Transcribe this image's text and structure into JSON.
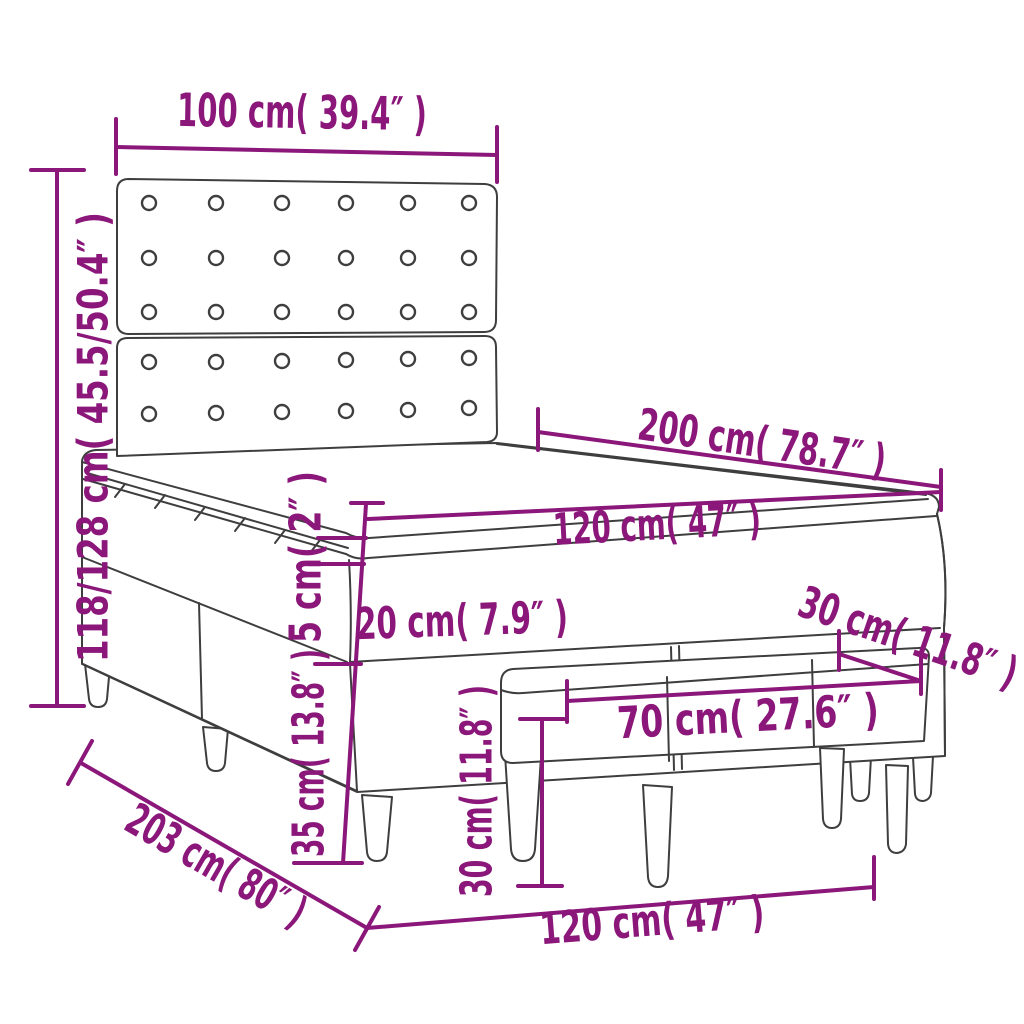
{
  "title": "Box spring bed with headboard and bench - dimension diagram",
  "colors": {
    "background": "#ffffff",
    "outline": "#3e3e3e",
    "dimension": "#8a1779"
  },
  "figure": {
    "type": "product-dimension-line-drawing",
    "components": [
      "headboard with buttons",
      "mattress topper",
      "mattress",
      "box spring base",
      "bed legs",
      "bench",
      "bench legs"
    ]
  },
  "dimensions": {
    "headboard_width": {
      "label": "100 cm( 39.4″ )",
      "cm": "100",
      "inch": "39.4"
    },
    "bed_height": {
      "label": "118/128 cm( 45.5/50.4″ )",
      "cm": "118/128",
      "inch": "45.5/50.4"
    },
    "bed_length": {
      "label": "200 cm( 78.7″ )",
      "cm": "200",
      "inch": "78.7"
    },
    "mattress_width": {
      "label": "120 cm( 47″ )",
      "cm": "120",
      "inch": "47"
    },
    "topper_thickness": {
      "label": "5 cm( 2″ )",
      "cm": "5",
      "inch": "2"
    },
    "mattress_thickness": {
      "label": "20 cm( 7.9″ )",
      "cm": "20",
      "inch": "7.9"
    },
    "bench_depth": {
      "label": "30 cm( 11.8″ )",
      "cm": "30",
      "inch": "11.8"
    },
    "bench_width": {
      "label": "70 cm( 27.6″ )",
      "cm": "70",
      "inch": "27.6"
    },
    "bench_height": {
      "label": "30 cm( 11.8″ )",
      "cm": "30",
      "inch": "11.8"
    },
    "base_height": {
      "label": "35 cm( 13.8″ )",
      "cm": "35",
      "inch": "13.8"
    },
    "total_length": {
      "label": "203 cm( 80″ )",
      "cm": "203",
      "inch": "80"
    },
    "bed_width": {
      "label": "120 cm( 47″ )",
      "cm": "120",
      "inch": "47"
    }
  }
}
